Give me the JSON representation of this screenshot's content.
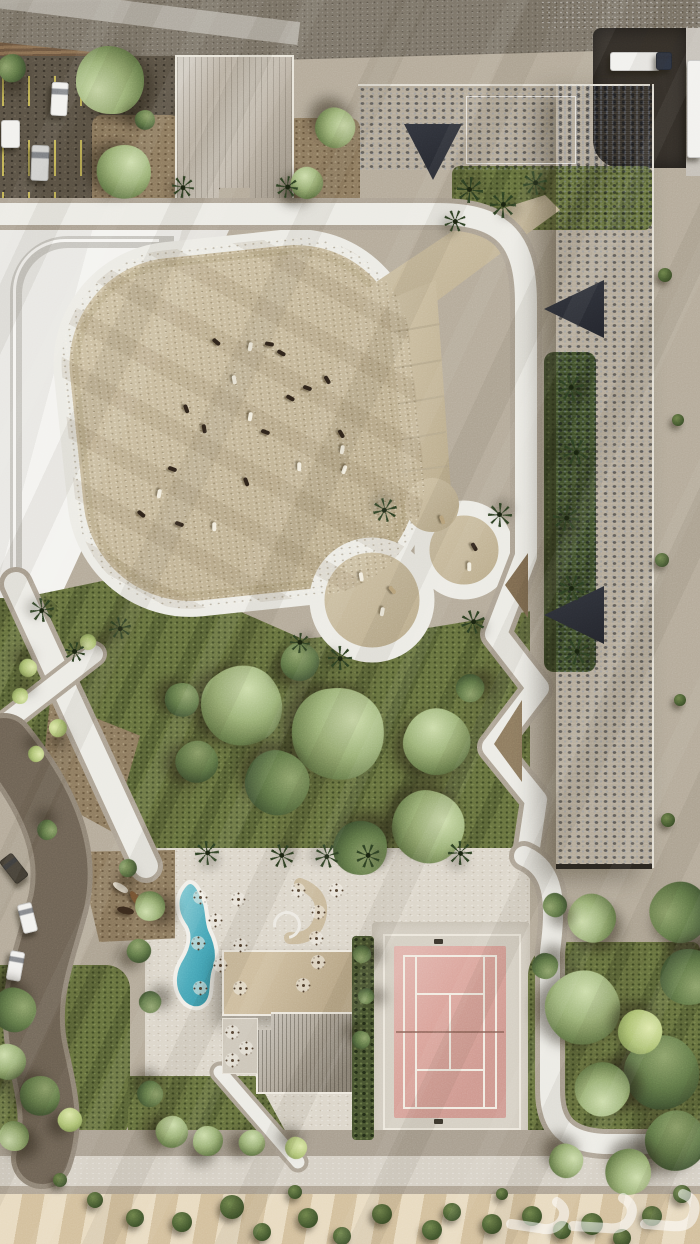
{
  "palette": {
    "gravel": "#b4aa99",
    "gravel-dark": "#8e8373",
    "sand": "#c9bc9f",
    "sand-dark": "#ab9c7c",
    "sand-light": "#e0d6bd",
    "lawn": "#67723f",
    "lawn-dark": "#47542e",
    "path-core": "#ecebe5",
    "path-case": "#aca293",
    "plaza-white": "#f1f0ed",
    "road-top": "#7b7468",
    "sidewalk": "#b2ada3",
    "asphalt": "#5a5245",
    "pline": "#d6c65a",
    "yard": "#35302a",
    "roof-rib": "#b9b0a2",
    "slate": "#3d414b",
    "rbrown": "#6b4f35",
    "roof-flat": "#c4b293",
    "court": "#daa39a",
    "cline": "#f2ece2",
    "apron": "#d5cfc3",
    "pool-light": "#8ed0d8",
    "pool-deep": "#2e8fa3",
    "hedgec": "#46522f",
    "dirt": "#8d7a5f",
    "bsand": "#dcc9a8",
    "road-left": "#6d6254",
    "road-left-case": "#8f8475",
    "palmc": "#2d4023",
    "animal-dark": "#2e231a",
    "animal-white": "#f2eddf",
    "animal-tan": "#bfa87f",
    "veh-white": "#f2f1ee",
    "veh-silver": "#cfcfcc",
    "veh-dark": "#423d34",
    "veh-navy": "#2e3440",
    "horse-white": "#ece4d4",
    "horse-brown": "#7a5634",
    "horse-dark": "#39291c",
    "watermark-white": "rgba(255,255,255,0.9)"
  },
  "watermark": {
    "style": "semi-transparent white logo, bottom-right"
  },
  "scene": {
    "trees": [
      [
        110,
        80,
        34,
        "sage"
      ],
      [
        124,
        172,
        27,
        "sage"
      ],
      [
        12,
        68,
        14,
        "dark"
      ],
      [
        335,
        128,
        20,
        "sage"
      ],
      [
        307,
        183,
        16,
        "sage"
      ],
      [
        145,
        120,
        10,
        "dark"
      ],
      [
        242,
        706,
        40,
        "sage"
      ],
      [
        338,
        734,
        46,
        "sage"
      ],
      [
        437,
        742,
        33,
        "sage"
      ],
      [
        277,
        783,
        32,
        "dark"
      ],
      [
        428,
        827,
        36,
        "sage"
      ],
      [
        360,
        848,
        27,
        "dark"
      ],
      [
        197,
        762,
        21,
        "dark"
      ],
      [
        182,
        700,
        17,
        "dark"
      ],
      [
        300,
        662,
        19,
        "dark"
      ],
      [
        470,
        688,
        14,
        "dark"
      ],
      [
        28,
        668,
        9,
        "lime"
      ],
      [
        20,
        696,
        8,
        "lime"
      ],
      [
        58,
        728,
        9,
        "lime"
      ],
      [
        36,
        754,
        8,
        "lime"
      ],
      [
        47,
        830,
        10,
        "dark"
      ],
      [
        88,
        642,
        8,
        "lime"
      ],
      [
        14,
        1010,
        22,
        "dark"
      ],
      [
        8,
        1062,
        18,
        "sage"
      ],
      [
        40,
        1096,
        20,
        "dark"
      ],
      [
        14,
        1136,
        15,
        "sage"
      ],
      [
        70,
        1120,
        12,
        "lime"
      ],
      [
        150,
        1094,
        13,
        "dark"
      ],
      [
        172,
        1132,
        16,
        "sage"
      ],
      [
        208,
        1141,
        15,
        "sage"
      ],
      [
        252,
        1143,
        13,
        "sage"
      ],
      [
        296,
        1148,
        11,
        "lime"
      ],
      [
        592,
        918,
        24,
        "sage"
      ],
      [
        583,
        1008,
        37,
        "sage"
      ],
      [
        680,
        912,
        30,
        "dark"
      ],
      [
        688,
        977,
        28,
        "dark"
      ],
      [
        662,
        1073,
        37,
        "dark"
      ],
      [
        602,
        1089,
        27,
        "sage"
      ],
      [
        676,
        1141,
        30,
        "dark"
      ],
      [
        628,
        1172,
        23,
        "sage"
      ],
      [
        566,
        1161,
        17,
        "sage"
      ],
      [
        640,
        1032,
        22,
        "lime"
      ],
      [
        545,
        966,
        13,
        "dark"
      ],
      [
        555,
        905,
        12,
        "dark"
      ],
      [
        150,
        906,
        15,
        "sage"
      ],
      [
        139,
        951,
        12,
        "dark"
      ],
      [
        362,
        954,
        9,
        "dark"
      ],
      [
        366,
        996,
        8,
        "dark"
      ],
      [
        361,
        1040,
        9,
        "dark"
      ],
      [
        150,
        1002,
        11,
        "dark"
      ],
      [
        128,
        868,
        9,
        "dark"
      ]
    ],
    "palms": [
      [
        470,
        190,
        13
      ],
      [
        503,
        205,
        13
      ],
      [
        535,
        183,
        12
      ],
      [
        455,
        221,
        11
      ],
      [
        571,
        388,
        13
      ],
      [
        576,
        452,
        13
      ],
      [
        566,
        518,
        13
      ],
      [
        572,
        588,
        13
      ],
      [
        577,
        652,
        13
      ],
      [
        385,
        510,
        12
      ],
      [
        500,
        515,
        12
      ],
      [
        473,
        622,
        12
      ],
      [
        340,
        658,
        12
      ],
      [
        300,
        643,
        10
      ],
      [
        42,
        610,
        12
      ],
      [
        75,
        652,
        10
      ],
      [
        120,
        628,
        11
      ],
      [
        207,
        853,
        12
      ],
      [
        282,
        856,
        12
      ],
      [
        327,
        856,
        12
      ],
      [
        368,
        856,
        12
      ],
      [
        460,
        853,
        12
      ],
      [
        183,
        187,
        11
      ],
      [
        287,
        187,
        11
      ]
    ],
    "shrubs": [
      [
        135,
        1218,
        9
      ],
      [
        182,
        1222,
        10
      ],
      [
        232,
        1207,
        12
      ],
      [
        262,
        1232,
        9
      ],
      [
        308,
        1218,
        10
      ],
      [
        342,
        1236,
        9
      ],
      [
        382,
        1214,
        10
      ],
      [
        432,
        1230,
        10
      ],
      [
        452,
        1212,
        9
      ],
      [
        492,
        1224,
        10
      ],
      [
        532,
        1216,
        10
      ],
      [
        562,
        1230,
        9
      ],
      [
        592,
        1224,
        11
      ],
      [
        622,
        1238,
        9
      ],
      [
        652,
        1216,
        10
      ],
      [
        682,
        1194,
        9
      ],
      [
        295,
        1192,
        7
      ],
      [
        502,
        1194,
        6
      ],
      [
        95,
        1200,
        8
      ],
      [
        60,
        1180,
        7
      ],
      [
        665,
        275,
        7
      ],
      [
        678,
        420,
        6
      ],
      [
        662,
        560,
        7
      ],
      [
        680,
        700,
        6
      ],
      [
        668,
        820,
        7
      ]
    ],
    "paddock_animals": [
      [
        212,
        340,
        40,
        "dark"
      ],
      [
        265,
        342,
        10,
        "dark"
      ],
      [
        277,
        351,
        30,
        "dark"
      ],
      [
        246,
        345,
        100,
        "white"
      ],
      [
        230,
        378,
        80,
        "white"
      ],
      [
        323,
        378,
        60,
        "dark"
      ],
      [
        286,
        396,
        30,
        "dark"
      ],
      [
        303,
        386,
        20,
        "dark"
      ],
      [
        182,
        407,
        70,
        "dark"
      ],
      [
        246,
        415,
        100,
        "white"
      ],
      [
        200,
        427,
        80,
        "dark"
      ],
      [
        261,
        430,
        20,
        "dark"
      ],
      [
        337,
        432,
        60,
        "dark"
      ],
      [
        338,
        448,
        100,
        "white"
      ],
      [
        295,
        465,
        90,
        "white"
      ],
      [
        340,
        468,
        110,
        "white"
      ],
      [
        168,
        467,
        20,
        "dark"
      ],
      [
        242,
        480,
        70,
        "dark"
      ],
      [
        155,
        492,
        100,
        "white"
      ],
      [
        137,
        512,
        40,
        "dark"
      ],
      [
        175,
        522,
        20,
        "dark"
      ],
      [
        210,
        525,
        90,
        "white"
      ],
      [
        357,
        575,
        80,
        "white"
      ],
      [
        388,
        588,
        50,
        "tan"
      ],
      [
        378,
        610,
        100,
        "white"
      ],
      [
        465,
        565,
        90,
        "white"
      ],
      [
        470,
        545,
        60,
        "dark"
      ],
      [
        438,
        518,
        70,
        "tan"
      ]
    ],
    "vehicles": [
      [
        51,
        82,
        15,
        32,
        3,
        "white",
        "pickup-truck"
      ],
      [
        31,
        145,
        16,
        34,
        2,
        "silver",
        "pickup-truck"
      ],
      [
        1,
        120,
        17,
        26,
        0,
        "white",
        "trailer"
      ],
      [
        610,
        52,
        48,
        17,
        0,
        "white",
        "semi-trailer"
      ],
      [
        656,
        52,
        14,
        16,
        0,
        "navy",
        "truck-cab"
      ],
      [
        687,
        60,
        13,
        96,
        0,
        "white",
        "box-truck"
      ],
      [
        6,
        854,
        14,
        27,
        -38,
        "dark",
        "suv"
      ],
      [
        20,
        903,
        13,
        28,
        -14,
        "white",
        "car"
      ],
      [
        8,
        951,
        13,
        28,
        10,
        "white",
        "car"
      ],
      [
        0,
        994,
        12,
        25,
        22,
        "silver",
        "car"
      ]
    ],
    "tables": [
      [
        200,
        897
      ],
      [
        238,
        899
      ],
      [
        215,
        920
      ],
      [
        198,
        943
      ],
      [
        240,
        945
      ],
      [
        220,
        965
      ],
      [
        200,
        988
      ],
      [
        240,
        988
      ],
      [
        318,
        912
      ],
      [
        316,
        938
      ],
      [
        318,
        962
      ],
      [
        303,
        985
      ],
      [
        336,
        890
      ],
      [
        298,
        890
      ],
      [
        232,
        1032
      ],
      [
        246,
        1048
      ],
      [
        232,
        1060
      ]
    ],
    "sculpture_horses": [
      [
        112,
        884,
        35,
        "white"
      ],
      [
        127,
        895,
        60,
        "brown"
      ],
      [
        117,
        907,
        15,
        "dark"
      ],
      [
        138,
        906,
        75,
        "white"
      ]
    ],
    "net_posts": [
      [
        434,
        939
      ],
      [
        434,
        1119
      ]
    ]
  }
}
